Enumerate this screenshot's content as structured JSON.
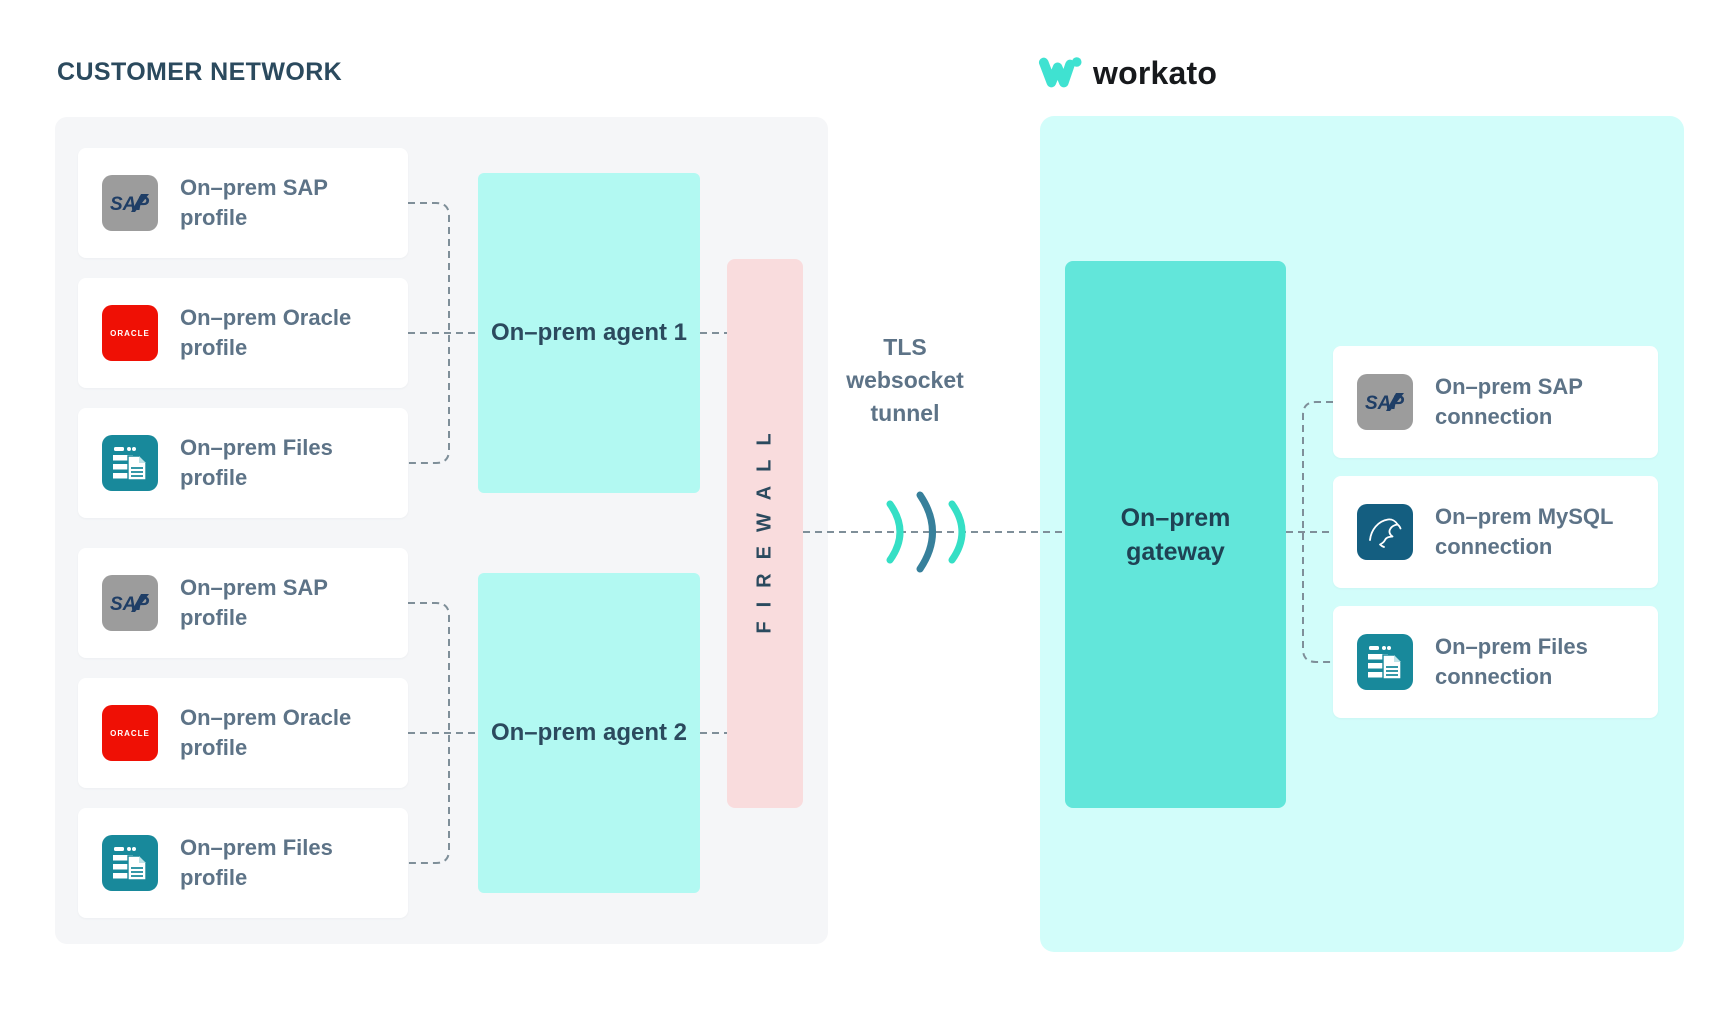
{
  "title": "CUSTOMER NETWORK",
  "logo": {
    "text": "workato"
  },
  "customer_network": {
    "profiles": [
      {
        "icon": "sap-icon",
        "label": "On–prem SAP profile"
      },
      {
        "icon": "oracle-icon",
        "label": "On–prem Oracle profile"
      },
      {
        "icon": "files-icon",
        "label": "On–prem Files profile"
      },
      {
        "icon": "sap-icon",
        "label": "On–prem SAP profile"
      },
      {
        "icon": "oracle-icon",
        "label": "On–prem Oracle profile"
      },
      {
        "icon": "files-icon",
        "label": "On–prem Files profile"
      }
    ],
    "agents": [
      {
        "label": "On–prem agent 1"
      },
      {
        "label": "On–prem agent 2"
      }
    ],
    "firewall": {
      "label": "FIREWALL"
    }
  },
  "tunnel": {
    "line1": "TLS",
    "line2": "websocket",
    "line3": "tunnel"
  },
  "workato_network": {
    "gateway": {
      "label": "On–prem gateway"
    },
    "connections": [
      {
        "icon": "sap-icon",
        "label": "On–prem SAP connection"
      },
      {
        "icon": "mysql-icon",
        "label": "On–prem MySQL connection"
      },
      {
        "icon": "files-icon",
        "label": "On–prem Files connection"
      }
    ]
  },
  "icon_text": {
    "sap": "SAP",
    "oracle": "ORACLE"
  },
  "colors": {
    "heading": "#2b4a5e",
    "card_label": "#5d7387",
    "panel_gray": "#f5f6f8",
    "panel_cyan": "#d2fdfa",
    "agent_fill": "#b2f9f2",
    "gateway_fill": "#62e6da",
    "firewall_fill": "#f9dcdd",
    "connector_gray": "#7f8f99",
    "arc_teal": "#35dfc5",
    "arc_dark_teal": "#37809b",
    "workato_teal": "#3fe2d1",
    "sap_gray": "#9c9c9c",
    "oracle_red": "#ef1005",
    "files_teal": "#18899b",
    "mysql_blue": "#145e80"
  }
}
